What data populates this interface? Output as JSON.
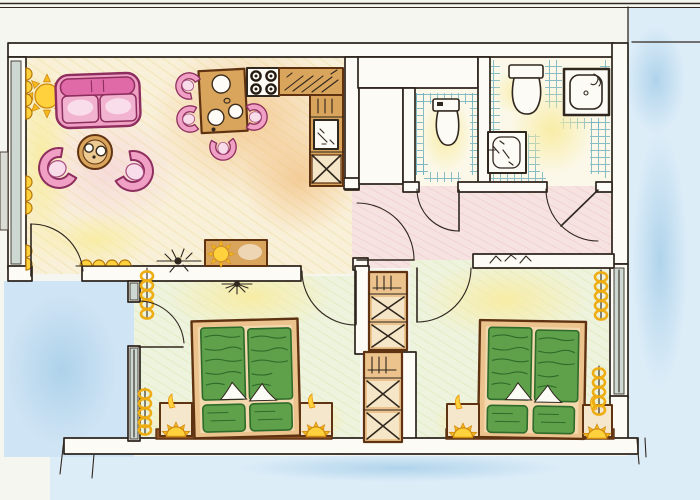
{
  "meta": {
    "type": "apartment floor plan",
    "style": "hand-drawn watercolor / colored-pencil sketch, top-down view",
    "text_content": "none (drawing only, no labels)"
  },
  "colors": {
    "paper": "#f6f6f0",
    "ink": "#30271e",
    "wall_white": "#fcfbf6",
    "outside_blue": "#ddedf8",
    "terrace_blue": "#cfe4f4",
    "living_wash": "#f9f0da",
    "hallway_wash": "#f6e3e1",
    "bedroom_wash": "#eef3de",
    "bath_wash": "#fbf8e9",
    "tile_teal": "#74b3c0",
    "glazing_grey": "#ccd8d1",
    "wood": "#d9a45c",
    "wood_light": "#ecc28d",
    "wood_dark": "#5f3312",
    "shelf_brown": "#8a5226",
    "furniture_pink": "#efa0c4",
    "sofa_magenta": "#e069a8",
    "outline_magenta": "#8e2e5e",
    "bed_green": "#5fa04b",
    "bed_green_dark": "#2f6b2a",
    "accent_yellow": "#ffd23d",
    "accent_orange": "#e8940c"
  },
  "rooms": [
    {
      "id": "living-room",
      "area": "top-left",
      "furniture": [
        "sofa",
        "coffee-table",
        "armchair-left",
        "armchair-right",
        "sideboard-with-lamp",
        "sun-lamp",
        "window-radiators",
        "ceiling-lamp",
        "terrace-door"
      ]
    },
    {
      "id": "kitchen",
      "area": "top-center, open to living room",
      "furniture": [
        "dining-table",
        "four-dining-chairs",
        "stove-4-burners",
        "counter-with-drainer",
        "sink-unit",
        "base-cabinet-x"
      ]
    },
    {
      "id": "wc",
      "area": "top-center-right, tiled",
      "furniture": [
        "toilet"
      ]
    },
    {
      "id": "bathroom",
      "area": "top-right, tiled",
      "furniture": [
        "toilet",
        "shower-tray",
        "washbasin"
      ]
    },
    {
      "id": "hallway",
      "area": "center, pink floor",
      "doors": [
        "living-room",
        "wc",
        "bathroom",
        "bedroom-1",
        "bedroom-2"
      ]
    },
    {
      "id": "bedroom-1",
      "area": "bottom-left",
      "furniture": [
        "double-bed",
        "nightstand-lamp-left",
        "nightstand-lamp-right",
        "wardrobe",
        "window-radiators",
        "terrace-door",
        "ceiling-lamp"
      ]
    },
    {
      "id": "bedroom-2",
      "area": "bottom-right",
      "furniture": [
        "double-bed",
        "nightstand-lamp-left",
        "nightstand-lamp-right",
        "wardrobe",
        "window-radiators",
        "window"
      ]
    },
    {
      "id": "terrace",
      "area": "outside, bottom-left, blue wash"
    }
  ]
}
